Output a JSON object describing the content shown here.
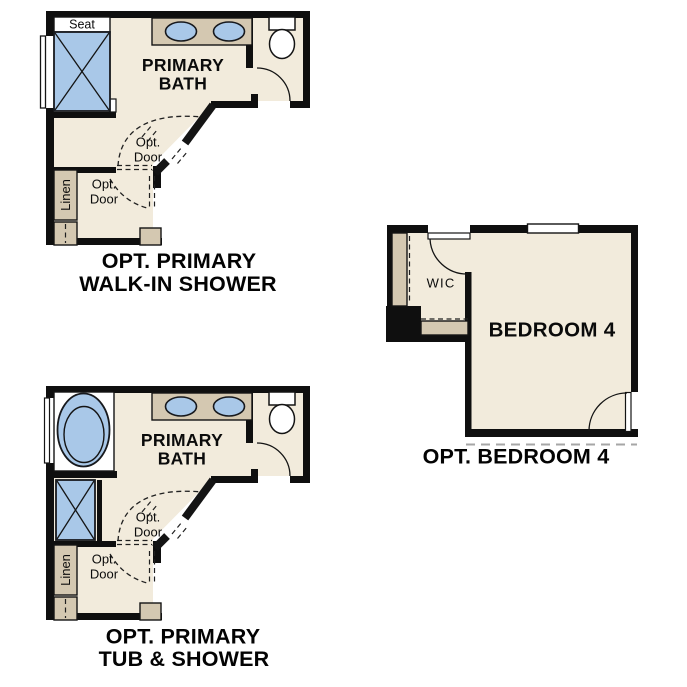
{
  "colors": {
    "background": "#ffffff",
    "wall": "#0f0f0f",
    "floor": "#f2ebdc",
    "cabinet": "#d4c8b1",
    "water": "#a9c8e8",
    "cutline": "#a6a6a6"
  },
  "plan_walk_in_shower": {
    "seat": "Seat",
    "room_line1": "PRIMARY",
    "room_line2": "BATH",
    "opt_door_a_line1": "Opt.",
    "opt_door_a_line2": "Door",
    "opt_door_b_line1": "Opt.",
    "opt_door_b_line2": "Door",
    "linen": "Linen",
    "caption_line1": "OPT. PRIMARY",
    "caption_line2": "WALK-IN SHOWER"
  },
  "plan_tub_shower": {
    "room_line1": "PRIMARY",
    "room_line2": "BATH",
    "opt_door_a_line1": "Opt.",
    "opt_door_a_line2": "Door",
    "opt_door_b_line1": "Opt.",
    "opt_door_b_line2": "Door",
    "linen": "Linen",
    "caption_line1": "OPT. PRIMARY",
    "caption_line2": "TUB & SHOWER"
  },
  "plan_bedroom4": {
    "wic": "WIC",
    "room": "BEDROOM 4",
    "caption": "OPT. BEDROOM 4"
  }
}
